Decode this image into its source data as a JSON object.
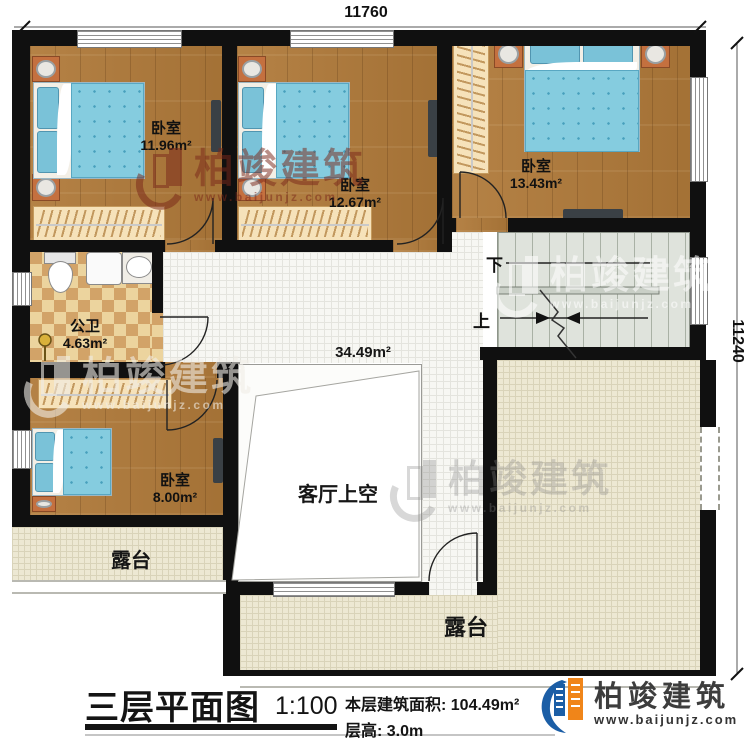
{
  "dimensions": {
    "top": "11760",
    "right": "11240"
  },
  "rooms": {
    "bedroom1": {
      "label": "卧室",
      "area": "11.96m²"
    },
    "bedroom2": {
      "label": "卧室",
      "area": "12.67m²"
    },
    "bedroom3": {
      "label": "卧室",
      "area": "13.43m²"
    },
    "bedroom4": {
      "label": "卧室",
      "area": "8.00m²"
    },
    "bathroom": {
      "label": "公卫",
      "area": "4.63m²"
    },
    "hall": {
      "area": "34.49m²"
    },
    "living_void": {
      "label": "客厅上空"
    },
    "terrace_left": {
      "label": "露台"
    },
    "terrace_main": {
      "label": "露台"
    }
  },
  "stairs": {
    "down_label": "下",
    "up_label": "上"
  },
  "footer": {
    "title": "三层平面图",
    "scale": "1:100",
    "floor_area": "本层建筑面积: 104.49m²",
    "floor_height": "层高: 3.0m"
  },
  "brand": {
    "name": "柏竣建筑",
    "url": "www.baijunjz.com"
  },
  "colors": {
    "wall": "#101010",
    "wood": "#b07a3a",
    "hall_tile": "#f7f7f3",
    "terrace_tile": "#ede8d3",
    "stair": "#dfe3dc",
    "bed_blue": "#85ccdf",
    "brand_blue": "#1b5ea6",
    "brand_orange": "#f08519",
    "watermark_red": "#7a281a"
  }
}
